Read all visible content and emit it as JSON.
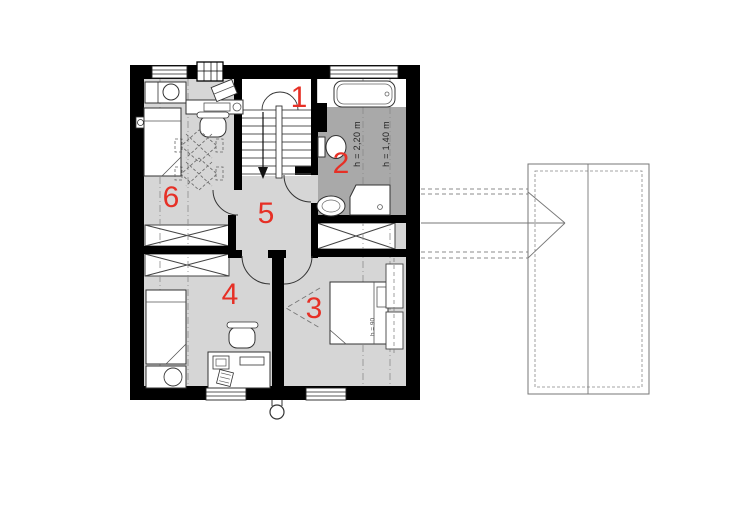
{
  "plan": {
    "rooms": [
      {
        "number": "1"
      },
      {
        "number": "2"
      },
      {
        "number": "3"
      },
      {
        "number": "4"
      },
      {
        "number": "5"
      },
      {
        "number": "6"
      }
    ],
    "annotations": {
      "bath_height_1": "h = 2,20 m",
      "bath_height_2": "h = 1,40 m",
      "bedroom_height": "h = 90"
    },
    "colors": {
      "wall": "#000000",
      "floor_light": "#d6d6d6",
      "floor_dark": "#a9a9a9",
      "label_red": "#e63026",
      "linework": "#333333",
      "roof_line": "#777777"
    }
  }
}
